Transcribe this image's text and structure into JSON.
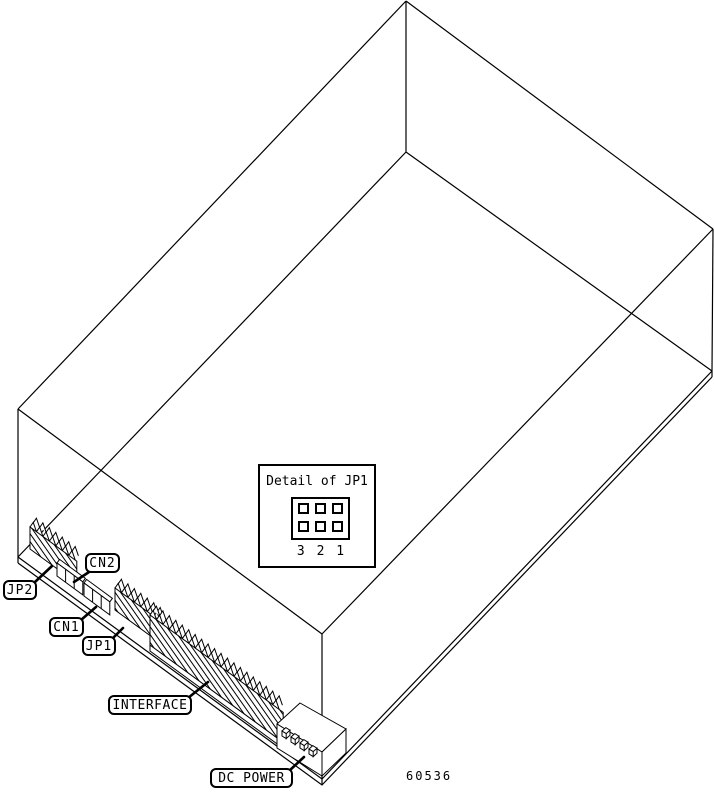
{
  "figure": {
    "number": "60536",
    "background": "#ffffff",
    "line_color": "#000000",
    "description": "Isometric line drawing of a disk drive with connector callouts"
  },
  "detail_inset": {
    "title": "Detail of JP1",
    "pin_rows": 2,
    "pin_cols": 3,
    "pin_numbers": [
      "3",
      "2",
      "1"
    ]
  },
  "labels": [
    {
      "id": "jp2",
      "text": "JP2"
    },
    {
      "id": "cn2",
      "text": "CN2"
    },
    {
      "id": "cn1",
      "text": "CN1"
    },
    {
      "id": "jp1",
      "text": "JP1"
    },
    {
      "id": "interface",
      "text": "INTERFACE"
    },
    {
      "id": "dc-power",
      "text": "DC POWER"
    }
  ]
}
